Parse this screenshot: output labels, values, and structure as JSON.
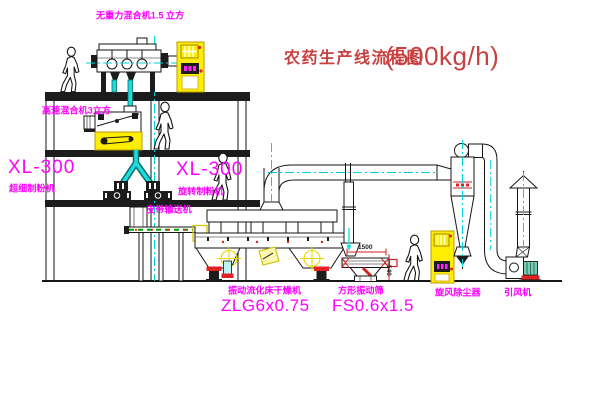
{
  "title": {
    "text": "农药生产线流程图",
    "capacity": "(500kg/h)"
  },
  "labels": {
    "gravity_mixer": "无重力混合机1.5 立方",
    "high_speed_mixer": "高速混合机3立方",
    "mill_left_model": "XL-300",
    "mill_left_name": "超细制粉机",
    "mill_right_model": "XL-300",
    "mill_right_name": "旋转制粉机",
    "belt_conveyor": "皮带输送机",
    "dryer_name": "振动流化床干燥机",
    "dryer_model": "ZLG6x0.75",
    "sieve_name": "方形振动筛",
    "sieve_model": "FS0.6x1.5",
    "cyclone": "旋风除尘器",
    "fan": "引风机"
  },
  "dimensions": {
    "sieve_length": "1500",
    "sieve_height": "540"
  },
  "colors": {
    "label_magenta": "#ff00ff",
    "title_red": "#c84040",
    "equipment_yellow": "#ffee00",
    "pipe_cyan": "#19dede",
    "dimension_red": "#dd2222"
  }
}
